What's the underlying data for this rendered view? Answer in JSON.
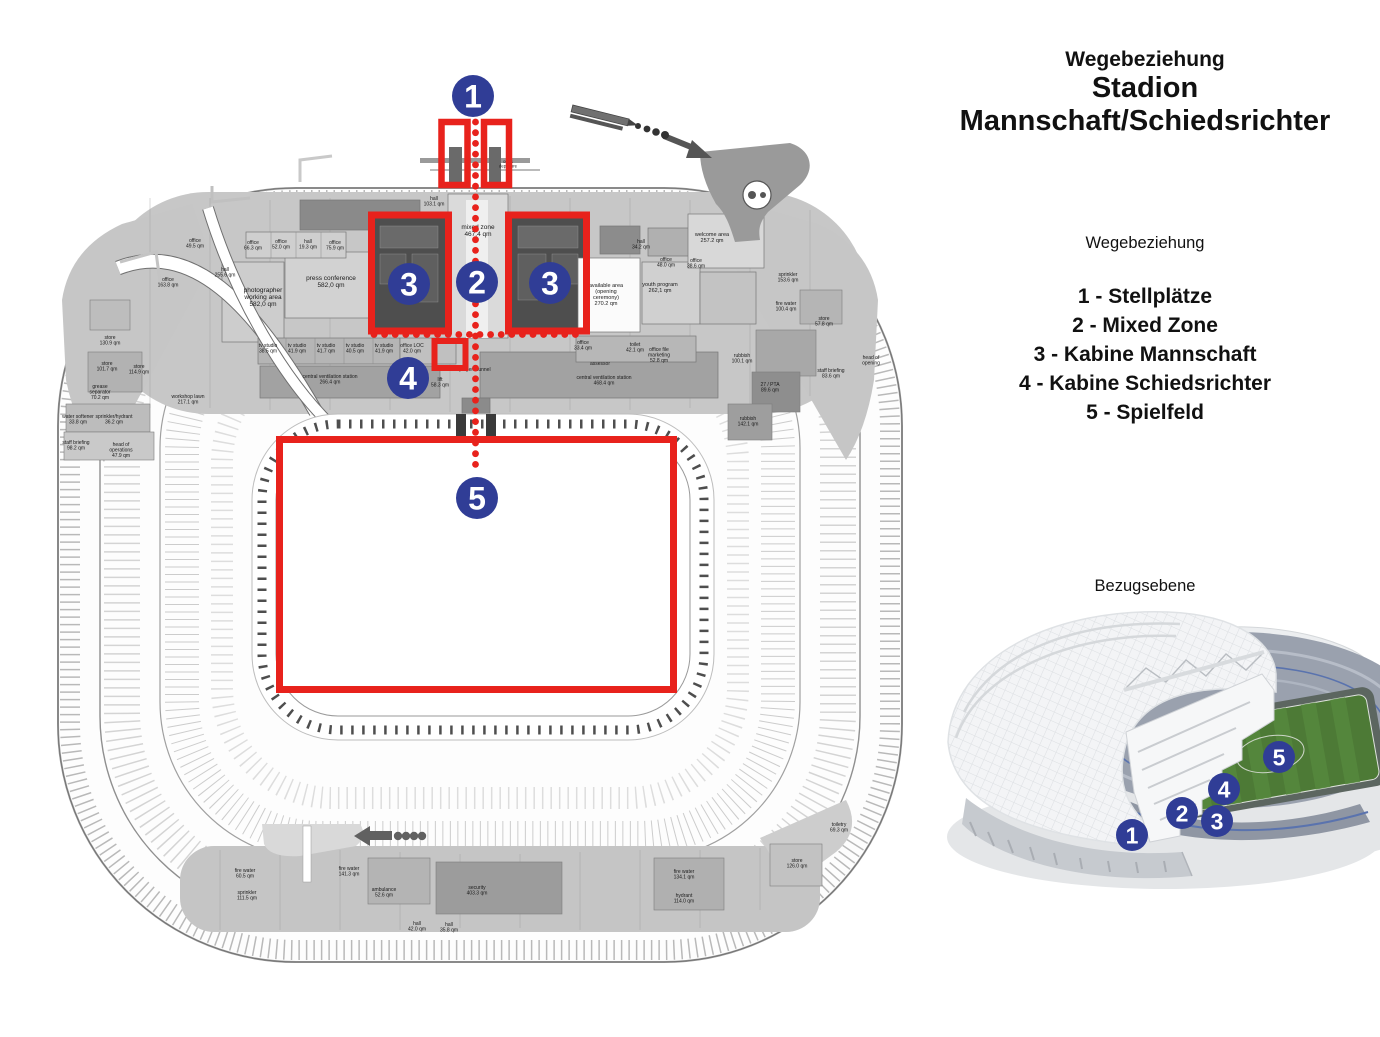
{
  "colors": {
    "route_red": "#E8221C",
    "marker_blue": "#303D96",
    "plan_grey": "#c7c7c7",
    "dark_room": "#4e4e4e",
    "pitch_green": "#4d7a36"
  },
  "right_panel": {
    "title_line1": "Wegebeziehung",
    "title_line2": "Stadion",
    "title_line3": "Mannschaft/Schiedsrichter",
    "legend_heading": "Wegebeziehung",
    "legend_items": [
      "1 - Stellplätze",
      "2 - Mixed Zone",
      "3 - Kabine Mannschaft",
      "4 - Kabine Schiedsrichter",
      "5 - Spielfeld"
    ],
    "section_label": "Bezugsebene"
  },
  "plan": {
    "markers": [
      {
        "label": "1",
        "x": 473,
        "y": 96
      },
      {
        "label": "2",
        "x": 477,
        "y": 282
      },
      {
        "label": "3",
        "x": 409,
        "y": 284
      },
      {
        "label": "3",
        "x": 550,
        "y": 283
      },
      {
        "label": "4",
        "x": 408,
        "y": 378
      },
      {
        "label": "5",
        "x": 477,
        "y": 498
      }
    ],
    "highlight_boxes": [
      {
        "x": 441.5,
        "y": 122,
        "w": 26,
        "h": 63,
        "sw": 6.5
      },
      {
        "x": 484,
        "y": 122,
        "w": 25,
        "h": 63,
        "sw": 6.5
      },
      {
        "x": 371.5,
        "y": 215,
        "w": 77,
        "h": 116,
        "sw": 7
      },
      {
        "x": 508.5,
        "y": 215,
        "w": 78,
        "h": 116,
        "sw": 7
      },
      {
        "x": 434.5,
        "y": 341,
        "w": 31,
        "h": 27,
        "sw": 6
      }
    ],
    "pitch_box": {
      "x": 279.5,
      "y": 439.5,
      "w": 394,
      "h": 250,
      "sw": 7
    },
    "route": {
      "vertical": {
        "x": 475.5,
        "y1": 122,
        "y2": 474,
        "step": 10.7,
        "r": 3.4
      },
      "horizontal": {
        "y": 334.5,
        "x1": 374,
        "x2": 584,
        "step": 10.6,
        "r": 3.4
      }
    },
    "room_labels": [
      {
        "x": 434,
        "y": 200,
        "text": "hall\n103.1 qm"
      },
      {
        "x": 478,
        "y": 229,
        "text": "mixed zone\n467,4 qm",
        "size": 6.5
      },
      {
        "x": 263,
        "y": 292,
        "text": "photographer\nworking area\n582,0 qm",
        "size": 6.5
      },
      {
        "x": 331,
        "y": 280,
        "text": "press conference\n582,0 qm",
        "size": 6.5
      },
      {
        "x": 606,
        "y": 287,
        "text": "available area\n(opening\nceremony)\n270.2 qm",
        "size": 5.5
      },
      {
        "x": 660,
        "y": 286,
        "text": "youth program\n262,1 qm",
        "size": 5.5
      },
      {
        "x": 712,
        "y": 236,
        "text": "welcome area\n257.2 qm",
        "size": 5.5
      },
      {
        "x": 641,
        "y": 243,
        "text": "hall\n34.2 qm"
      },
      {
        "x": 666,
        "y": 261,
        "text": "office\n48.0 qm"
      },
      {
        "x": 696,
        "y": 262,
        "text": "office\n38.6 qm"
      },
      {
        "x": 268,
        "y": 347,
        "text": "tv studio\n38.5 qm"
      },
      {
        "x": 297,
        "y": 347,
        "text": "tv studio\n41.9 qm"
      },
      {
        "x": 326,
        "y": 347,
        "text": "tv studio\n41.7 qm"
      },
      {
        "x": 355,
        "y": 347,
        "text": "tv studio\n40.5 qm"
      },
      {
        "x": 384,
        "y": 347,
        "text": "tv studio\n41.9 qm"
      },
      {
        "x": 412,
        "y": 347,
        "text": "office LOC\n42.0 qm"
      },
      {
        "x": 330,
        "y": 378,
        "text": "central ventilation station\n266.4 qm"
      },
      {
        "x": 604,
        "y": 379,
        "text": "central ventilation station\n468.4 qm"
      },
      {
        "x": 475,
        "y": 371,
        "text": "players tunnel"
      },
      {
        "x": 440,
        "y": 381,
        "text": "lift\n58.3 qm"
      },
      {
        "x": 583,
        "y": 344,
        "text": "office\n33.4 qm"
      },
      {
        "x": 635,
        "y": 346,
        "text": "toilet\n42.1 qm"
      },
      {
        "x": 659,
        "y": 351,
        "text": "office file\nmarketing\n52.8 qm"
      },
      {
        "x": 600,
        "y": 365,
        "text": "assessor"
      },
      {
        "x": 188,
        "y": 398,
        "text": "workshop lawn\n217.1 qm"
      },
      {
        "x": 168,
        "y": 281,
        "text": "office\n163.8 qm"
      },
      {
        "x": 225,
        "y": 271,
        "text": "hall\n255.6 qm"
      },
      {
        "x": 195,
        "y": 242,
        "text": "office\n49.5 qm"
      },
      {
        "x": 253,
        "y": 244,
        "text": "office\n66.3 qm"
      },
      {
        "x": 281,
        "y": 243,
        "text": "office\n52.0 qm"
      },
      {
        "x": 308,
        "y": 243,
        "text": "hall\n19.3 qm"
      },
      {
        "x": 335,
        "y": 244,
        "text": "office\n75.9 qm"
      },
      {
        "x": 110,
        "y": 339,
        "text": "store\n130.9 qm"
      },
      {
        "x": 107,
        "y": 365,
        "text": "store\n101.7 qm"
      },
      {
        "x": 139,
        "y": 368,
        "text": "store\n114.9 qm"
      },
      {
        "x": 100,
        "y": 388,
        "text": "grease\nseparator\n70.2 qm"
      },
      {
        "x": 78,
        "y": 418,
        "text": "water softener\n33.8 qm"
      },
      {
        "x": 114,
        "y": 418,
        "text": "sprinkler/hydrant\n36.2 qm"
      },
      {
        "x": 76,
        "y": 444,
        "text": "staff briefing\n98.2 qm"
      },
      {
        "x": 121,
        "y": 446,
        "text": "head of\noperations\n47.9 qm"
      },
      {
        "x": 788,
        "y": 276,
        "text": "sprinkler\n153.6 qm"
      },
      {
        "x": 786,
        "y": 305,
        "text": "fire water\n100.4 qm"
      },
      {
        "x": 824,
        "y": 320,
        "text": "store\n57.8 qm"
      },
      {
        "x": 742,
        "y": 357,
        "text": "rubbish\n100.1 qm"
      },
      {
        "x": 770,
        "y": 386,
        "text": "27 / PTA\n89.6 qm"
      },
      {
        "x": 748,
        "y": 420,
        "text": "rubbish\n142.1 qm"
      },
      {
        "x": 831,
        "y": 372,
        "text": "staff briefing\n83.6 qm"
      },
      {
        "x": 871,
        "y": 359,
        "text": "head of\nopening"
      },
      {
        "x": 245,
        "y": 872,
        "text": "fire water\n60.5 qm"
      },
      {
        "x": 247,
        "y": 894,
        "text": "sprinkler\n111.5 qm"
      },
      {
        "x": 349,
        "y": 870,
        "text": "fire water\n141.3 qm"
      },
      {
        "x": 477,
        "y": 889,
        "text": "security\n403.3 qm"
      },
      {
        "x": 384,
        "y": 891,
        "text": "ambulance\n52.6 qm"
      },
      {
        "x": 417,
        "y": 925,
        "text": "hall\n42.0 qm"
      },
      {
        "x": 449,
        "y": 926,
        "text": "hall\n35.8 qm"
      },
      {
        "x": 684,
        "y": 873,
        "text": "fire water\n134.1 qm"
      },
      {
        "x": 684,
        "y": 897,
        "text": "hydrant\n114.0 qm"
      },
      {
        "x": 797,
        "y": 862,
        "text": "store\n126.0 qm"
      },
      {
        "x": 839,
        "y": 826,
        "text": "toiletry\n69.3 qm"
      },
      {
        "x": 508,
        "y": 163,
        "text": "out &\ndeparture",
        "size": 4.2
      }
    ]
  },
  "stadium3d": {
    "markers": [
      {
        "label": "1",
        "x": 192,
        "y": 243
      },
      {
        "label": "2",
        "x": 242,
        "y": 221
      },
      {
        "label": "3",
        "x": 277,
        "y": 229
      },
      {
        "label": "4",
        "x": 284,
        "y": 197
      },
      {
        "label": "5",
        "x": 339,
        "y": 165
      }
    ]
  }
}
